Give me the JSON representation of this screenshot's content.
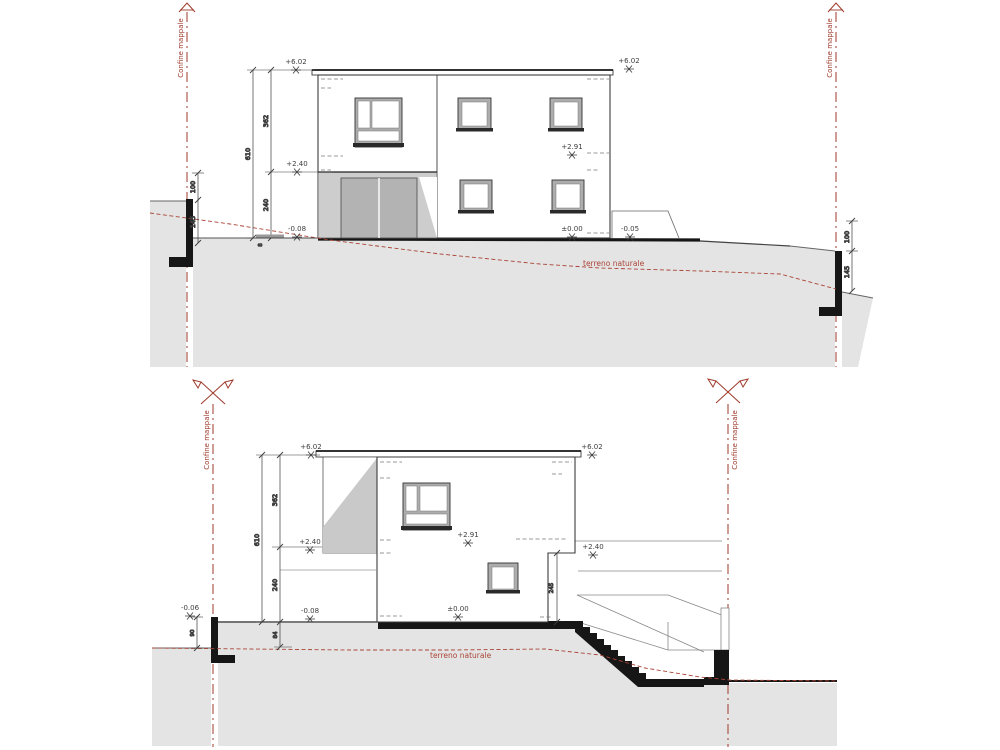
{
  "labels": {
    "boundary": "Confine mappale",
    "terrain": "terreno naturale"
  },
  "colors": {
    "boundary_red": "#9E3A2B",
    "terrain_red": "#A94436",
    "terrain_fill": "#E4E4E4",
    "shade_gray": "#C9C9C9",
    "door_gray": "#B3B3B3",
    "line_dark": "#3C3C3C",
    "solid_black": "#161616"
  },
  "elev1": {
    "lvl_top_left": "+6.02",
    "lvl_top_right": "+6.02",
    "lvl_mid_left": "+2.40",
    "lvl_mid_right": "+2.91",
    "lvl_zero": "±0.00",
    "lvl_minus05": "-0.05",
    "lvl_minus08": "-0.08",
    "dim_total": "610",
    "dim_upper": "362",
    "dim_lower": "240",
    "dim_wall_l_top": "100",
    "dim_wall_l_bot": "145",
    "dim_wall_r_top": "100",
    "dim_wall_r_bot": "145",
    "dim_step": "8"
  },
  "elev2": {
    "lvl_top_left": "+6.02",
    "lvl_top_right": "+6.02",
    "lvl_mid_left": "+2.40",
    "lvl_mid_right": "+2.40",
    "lvl_mid_center": "+2.91",
    "lvl_zero": "±0.00",
    "lvl_minus08": "-0.08",
    "lvl_minus06": "-0.06",
    "dim_total": "610",
    "dim_upper": "362",
    "dim_lower": "240",
    "dim_ground": "84",
    "dim_wall_l": "90",
    "dim_recess": "245"
  }
}
